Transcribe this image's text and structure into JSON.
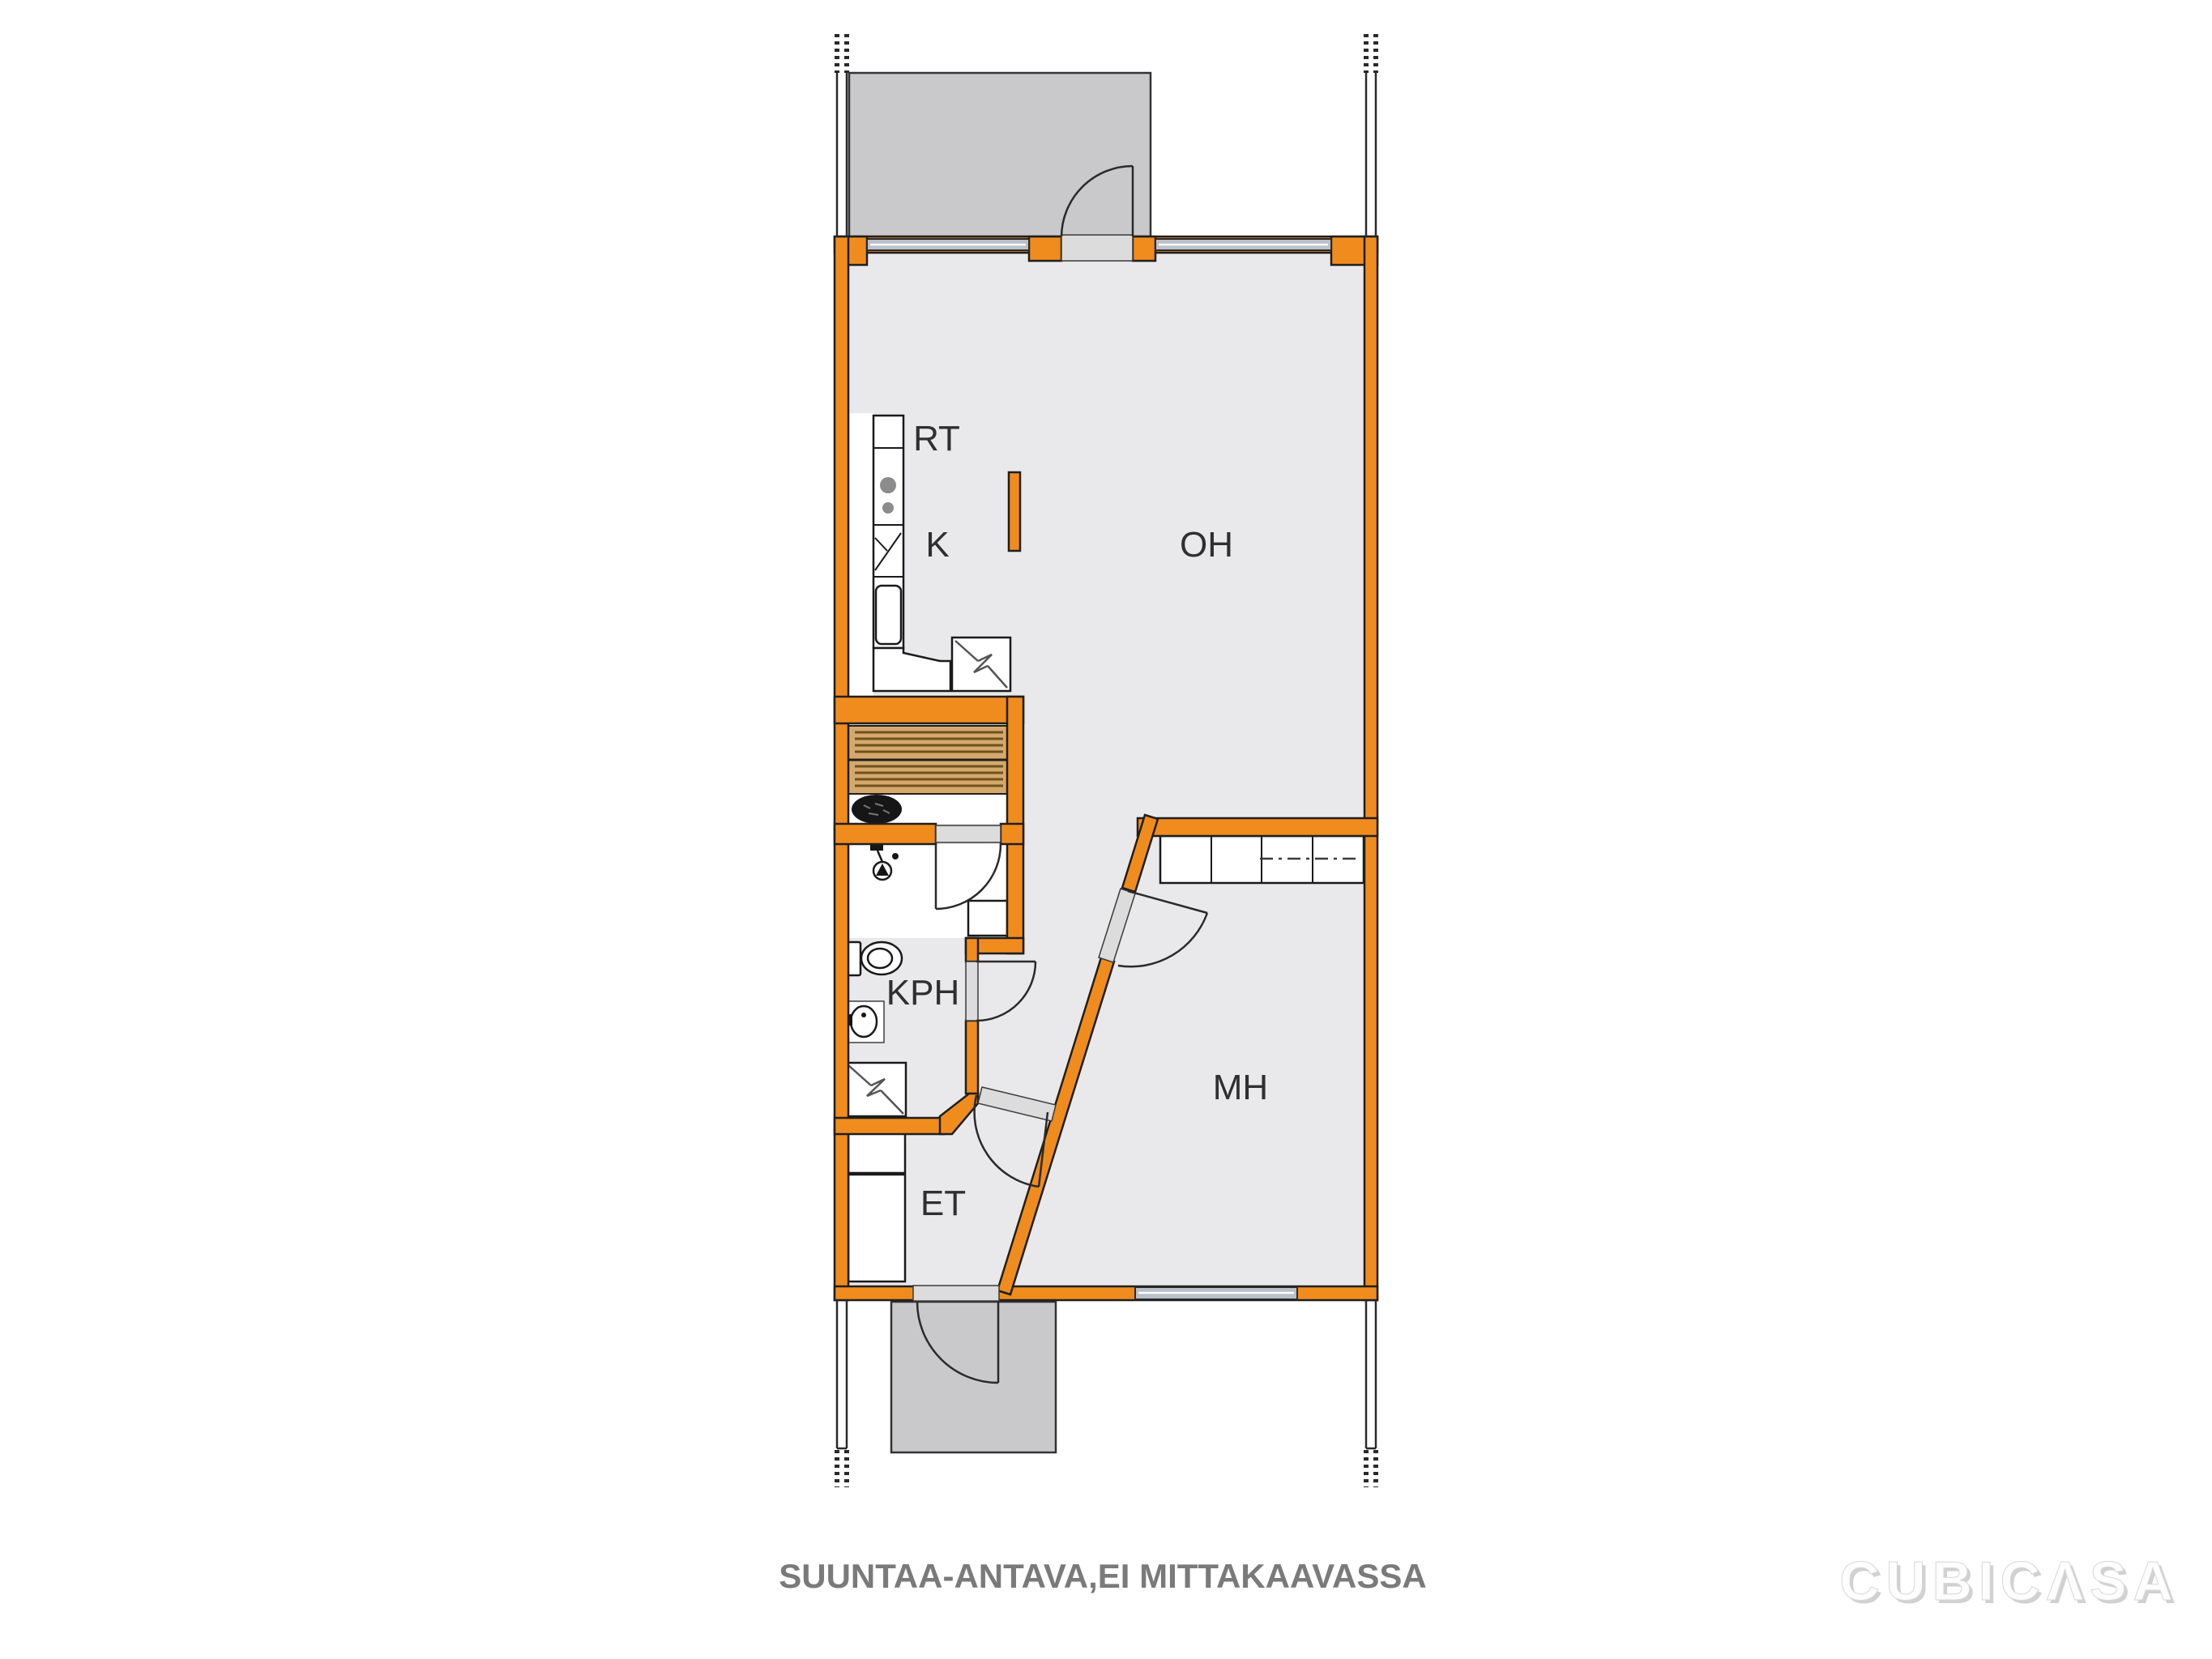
{
  "floorplan": {
    "rooms": [
      {
        "id": "rt",
        "label": "RT"
      },
      {
        "id": "k",
        "label": "K"
      },
      {
        "id": "oh",
        "label": "OH"
      },
      {
        "id": "kph",
        "label": "KPH"
      },
      {
        "id": "mh",
        "label": "MH"
      },
      {
        "id": "et",
        "label": "ET"
      }
    ],
    "footer": {
      "disclaimer": "SUUNTAA-ANTAVA,EI MITTAKAAVASSA"
    },
    "watermark": {
      "brand": "CUBICΛSA"
    },
    "colors": {
      "wall": "#F08C1E",
      "floor": "#E9E9EB",
      "terrace": "#C9C9CB",
      "window": "#B9C0CA",
      "threshold": "#DCDCDC",
      "sauna_wood": "#D5A96B",
      "label_text": "#2F2F2F",
      "disclaimer_text": "#7A7A7A"
    }
  }
}
